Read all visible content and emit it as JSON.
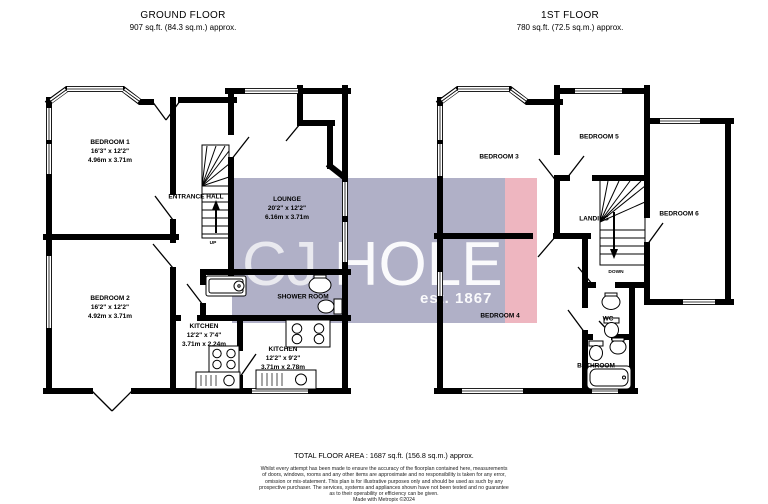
{
  "ground_floor": {
    "title": "GROUND FLOOR",
    "area": "907 sq.ft. (84.3 sq.m.) approx.",
    "stair_direction": "UP",
    "rooms": {
      "bedroom1": {
        "name": "BEDROOM 1",
        "imperial": "16'3\" x 12'2\"",
        "metric": "4.96m x 3.71m"
      },
      "bedroom2": {
        "name": "BEDROOM 2",
        "imperial": "16'2\" x 12'2\"",
        "metric": "4.92m x 3.71m"
      },
      "entrance_hall": {
        "name": "ENTRANCE HALL"
      },
      "lounge": {
        "name": "LOUNGE",
        "imperial": "20'2\" x 12'2\"",
        "metric": "6.16m x 3.71m"
      },
      "shower_room": {
        "name": "SHOWER ROOM"
      },
      "kitchen_small": {
        "name": "KITCHEN",
        "imperial": "12'2\" x 7'4\"",
        "metric": "3.71m x 2.24m"
      },
      "kitchen_large": {
        "name": "KITCHEN",
        "imperial": "12'2\" x 9'2\"",
        "metric": "3.71m x 2.78m"
      }
    }
  },
  "first_floor": {
    "title": "1ST FLOOR",
    "area": "780 sq.ft. (72.5 sq.m.) approx.",
    "stair_direction": "DOWN",
    "rooms": {
      "bedroom3": {
        "name": "BEDROOM 3"
      },
      "bedroom4": {
        "name": "BEDROOM 4"
      },
      "bedroom5": {
        "name": "BEDROOM 5"
      },
      "bedroom6": {
        "name": "BEDROOM 6"
      },
      "landing": {
        "name": "LANDING"
      },
      "wc": {
        "name": "WC"
      },
      "bathroom": {
        "name": "BATHROOM"
      }
    }
  },
  "watermark": {
    "brand_prefix": "CJ",
    "brand_main": "HOLE",
    "tagline": "est. 1867",
    "tint_color": "#a2a2bd",
    "stripe_color": "#eba9b5"
  },
  "footer": {
    "total_area": "TOTAL FLOOR AREA : 1687 sq.ft. (156.8 sq.m.) approx.",
    "disclaimer": [
      "Whilst every attempt has been made to ensure the accuracy of the floorplan contained here, measurements",
      "of doors, windows, rooms and any other items are approximate and no responsibility is taken for any error,",
      "omission or mis-statement. This plan is for illustrative purposes only and should be used as such by any",
      "prospective purchaser. The services, systems and appliances shown have not been tested and no guarantee",
      "as to their operability or efficiency can be given."
    ],
    "credit": "Made with Metropix ©2024"
  }
}
